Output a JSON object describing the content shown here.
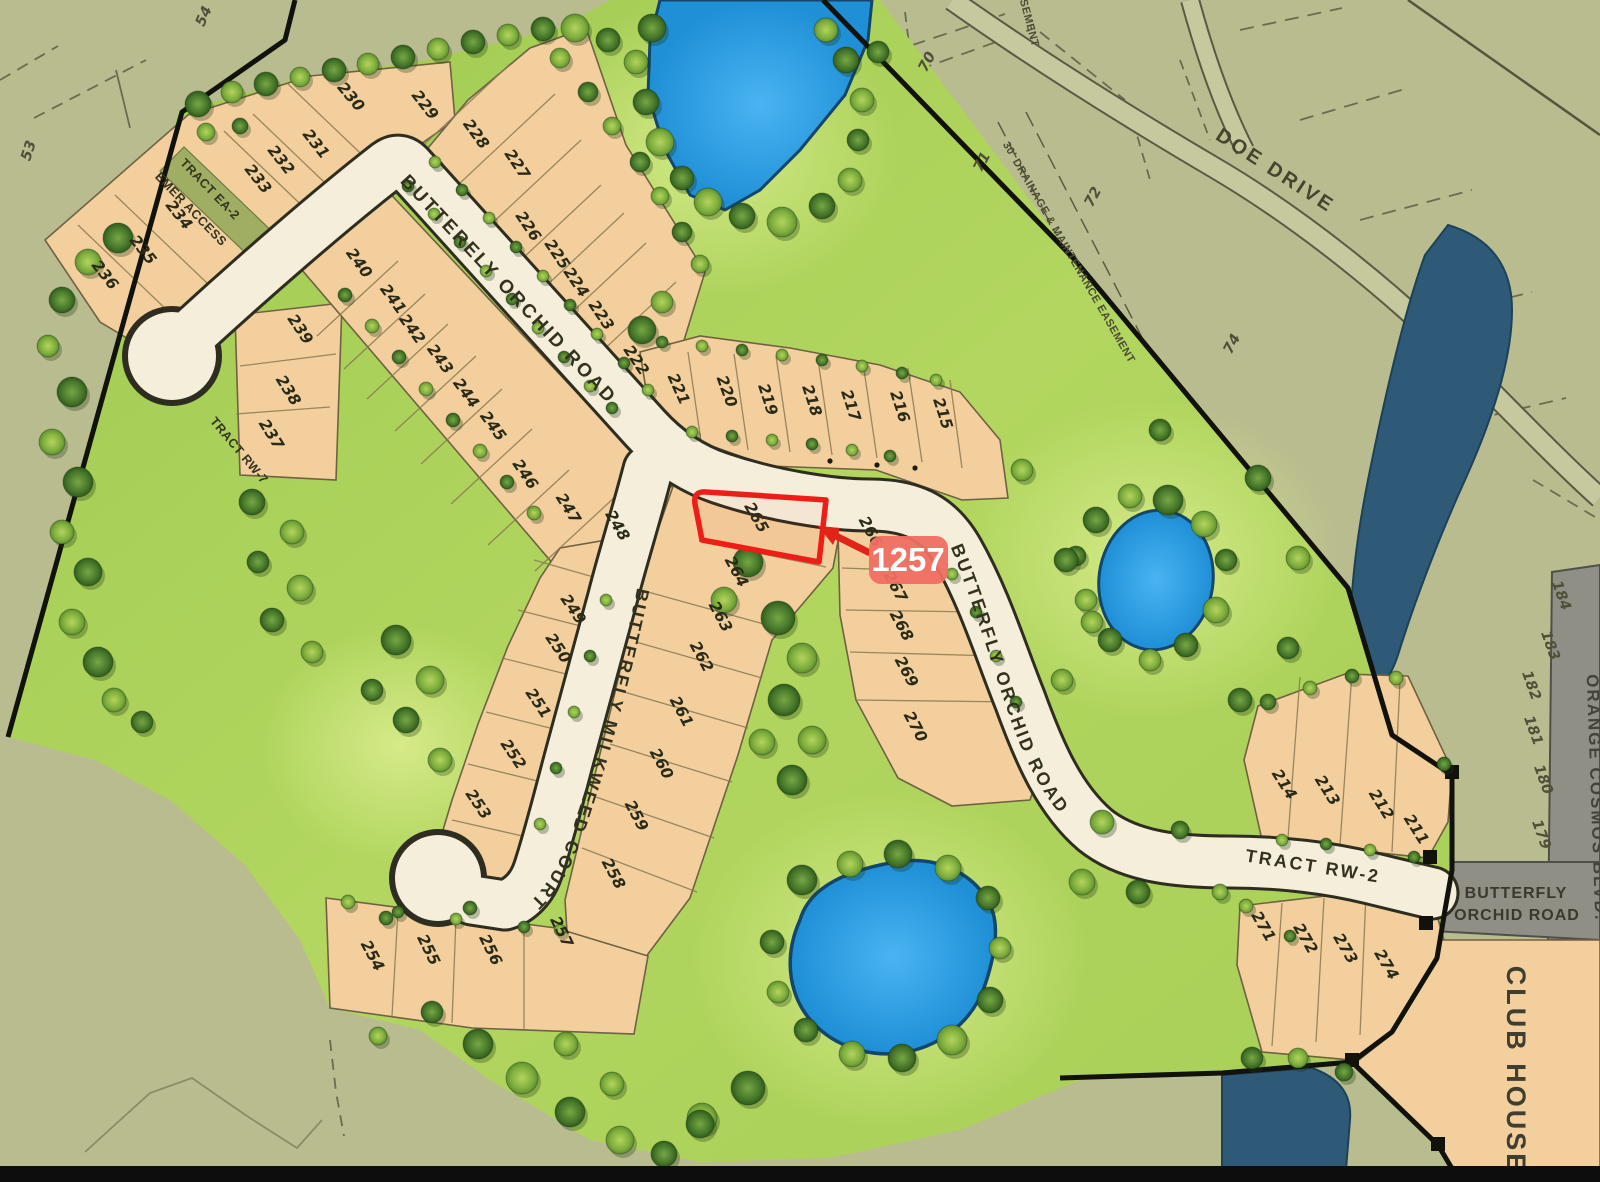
{
  "highlight": {
    "badge": "1257",
    "lot": "265",
    "badge_color": "#ef6e62",
    "arrow_color": "#e02418",
    "outline_color": "#ee1d18"
  },
  "roads": {
    "orchid_upper": "BUTTERELY ORCHID ROAD",
    "milkweed": "BUTTERFLY MILKWEED COURT",
    "orchid_curve": "BUTTERFLY   ORCHID   ROAD",
    "tract_rw2": "TRACT RW-2",
    "doe_drive": "DOE DRIVE",
    "orange_cosmos": "ORANGE COSMOS BLVD.",
    "orchid_east_1": "BUTTERFLY",
    "orchid_east_2": "ORCHID ROAD"
  },
  "labels": {
    "club_house": "CLUB HOUSE",
    "tract_ea2": "TRACT EA-2",
    "emer_access": "EMER ACCESS",
    "tract_7": "TRACT RW-7",
    "drainage_easement": "30' DRAINAGE & MAINTENANCE EASEMENT",
    "easement_partial": "EASEMENT"
  },
  "lots": {
    "clusters": {
      "north_band": [
        "222",
        "223",
        "224",
        "225",
        "226",
        "227",
        "228",
        "229"
      ],
      "east_band": [
        "215",
        "216",
        "217",
        "218",
        "219",
        "220",
        "221"
      ],
      "northwest_band": [
        "230",
        "231",
        "232",
        "233",
        "234",
        "235",
        "236"
      ],
      "west_band": [
        "237",
        "238",
        "239"
      ],
      "road_band": [
        "240",
        "241",
        "242",
        "243",
        "244",
        "245",
        "246",
        "247",
        "248"
      ],
      "milkweed_west": [
        "249",
        "250",
        "251",
        "252",
        "253"
      ],
      "south_band": [
        "254",
        "255",
        "256",
        "257"
      ],
      "milkweed_east": [
        "258",
        "259",
        "260",
        "261",
        "262",
        "263",
        "264"
      ],
      "highlighted": [
        "265"
      ],
      "orchid_band": [
        "266",
        "267",
        "268",
        "269",
        "270"
      ],
      "se_north": [
        "211",
        "212",
        "213",
        "214"
      ],
      "se_south": [
        "271",
        "272",
        "273",
        "274"
      ]
    },
    "offsite": [
      "53",
      "54",
      "70",
      "71",
      "72",
      "74",
      "179",
      "180",
      "181",
      "182",
      "183",
      "184"
    ]
  },
  "colors": {
    "background_khaki": "#b9bc8e",
    "community_green": "#aed25c",
    "lot_tan": "#f2cf9d",
    "road_cream": "#f4eedb",
    "pond_blue": "#2e9fe6",
    "deep_water_navy": "#2e5a77",
    "gray_road": "#8f8f85",
    "boundary_black": "#12120c"
  }
}
